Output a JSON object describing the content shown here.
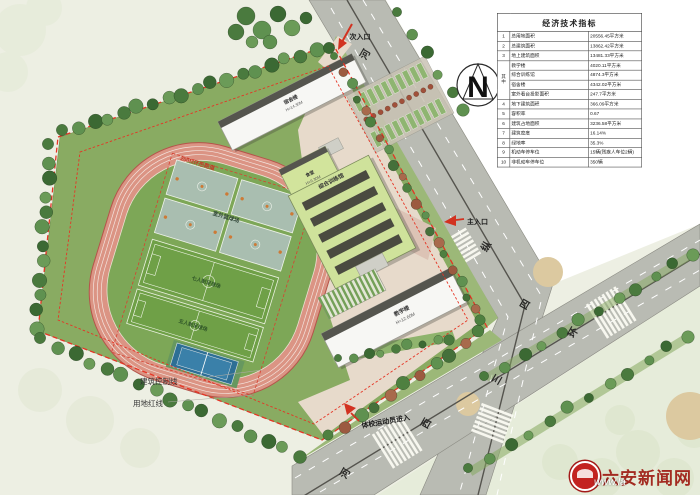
{
  "plan": {
    "north": "N",
    "entrances": {
      "secondary": "次入口",
      "main": "主入口",
      "athlete": "体校运动员进入"
    },
    "boundary": {
      "control_line": "建筑控制线",
      "red_line": "用地红线"
    },
    "sports": {
      "track": "200M环形跑道",
      "basketball": "室外篮球场",
      "soccer_a": "七人制足球场",
      "soccer_b": "五人制足球场"
    },
    "buildings": {
      "dorm": {
        "name": "宿舍楼",
        "height": "H=14.30M"
      },
      "canteen": {
        "name": "食堂",
        "height": "H=9.30M"
      },
      "training": {
        "name": "综合训练馆",
        "height": "H=12.30M"
      },
      "teaching": {
        "name": "教学楼",
        "height": "H=12.60M"
      }
    },
    "roads": {
      "labels": [
        "河",
        "纵",
        "四",
        "环",
        "三",
        "西",
        "河"
      ]
    }
  },
  "table": {
    "title": "经济技术指标",
    "rows": [
      {
        "no": "1",
        "name": "总用地面积",
        "value": "20556.45平方米"
      },
      {
        "no": "2",
        "name": "总建筑面积",
        "value": "13862.42平方米"
      },
      {
        "no": "3",
        "name": "地上建筑面积",
        "value": "13481.33平方米"
      },
      {
        "no": "其中",
        "span": 4,
        "name": "教学楼",
        "value": "4020.11平方米"
      },
      {
        "name": "综合训练馆",
        "value": "4874.3平方米"
      },
      {
        "name": "宿舍楼",
        "value": "4342.02平方米"
      },
      {
        "name": "室外看台投影面积",
        "value": "247.7平方米"
      },
      {
        "no": "4",
        "name": "地下建筑面积",
        "value": "366.09平方米"
      },
      {
        "no": "5",
        "name": "容积率",
        "value": "0.67"
      },
      {
        "no": "6",
        "name": "建筑占地面积",
        "value": "3236.58平方米"
      },
      {
        "no": "7",
        "name": "建筑密度",
        "value": "16.14%"
      },
      {
        "no": "8",
        "name": "绿地率",
        "value": "35.3%"
      },
      {
        "no": "9",
        "name": "机动车停车位",
        "value": "15辆(残疾人车位2辆)"
      },
      {
        "no": "10",
        "name": "非机动车停车位",
        "value": "350辆"
      }
    ]
  },
  "watermark": {
    "name": "六安新闻网",
    "url": "www.la"
  }
}
